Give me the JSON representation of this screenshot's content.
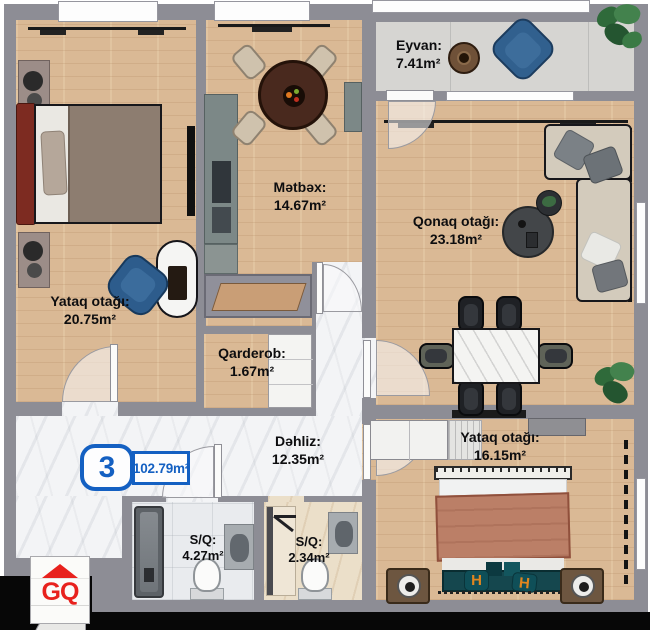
{
  "plan": {
    "unit_badge": {
      "number": "3",
      "total_area": "102.79m²"
    },
    "logo": {
      "text": "GQ"
    },
    "decor": {
      "h_monogram": "H"
    },
    "rooms": {
      "bedroom1": {
        "name": "Yataq otağı:",
        "area": "20.75m²"
      },
      "kitchen": {
        "name": "Mətbəx:",
        "area": "14.67m²"
      },
      "balcony": {
        "name": "Eyvan:",
        "area": "7.41m²"
      },
      "living": {
        "name": "Qonaq otağı:",
        "area": "23.18m²"
      },
      "wardrobe": {
        "name": "Qarderob:",
        "area": "1.67m²"
      },
      "hallway": {
        "name": "Dəhliz:",
        "area": "12.35m²"
      },
      "bedroom2": {
        "name": "Yataq otağı:",
        "area": "16.15m²"
      },
      "bathroom1": {
        "name": "S/Q:",
        "area": "4.27m²"
      },
      "bathroom2": {
        "name": "S/Q:",
        "area": "2.34m²"
      }
    },
    "colors": {
      "badge_blue": "#1460c2",
      "logo_red": "#e8211d",
      "wall_gray": "#8d8d95",
      "wood_floor": "#dab995",
      "marble_floor": "#f3f4f6",
      "balcony_floor": "#d6d5d2",
      "accent_navy": "#2e5d8c",
      "accent_teal": "#15474e"
    }
  }
}
